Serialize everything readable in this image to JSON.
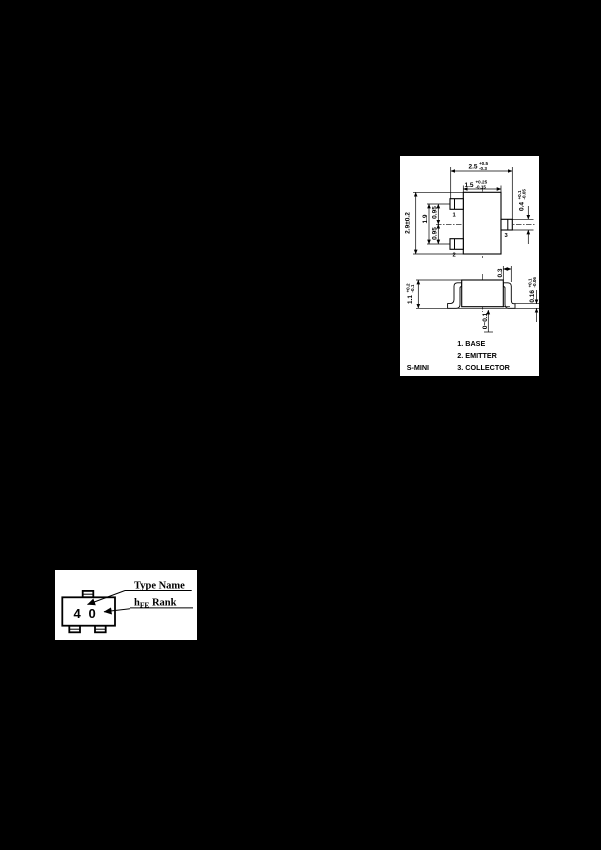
{
  "page": {
    "background_color": "#000000",
    "paper_color": "#ffffff"
  },
  "package_outline": {
    "package_name": "S-MINI",
    "pin_legend": {
      "pin1": "1. BASE",
      "pin2": "2. EMITTER",
      "pin3": "3. COLLECTOR"
    },
    "pin_numbers": {
      "pin1": "1",
      "pin2": "2",
      "pin3": "3"
    },
    "top_view": {
      "overall_width": {
        "value": "2.5",
        "plus": "+0.5",
        "minus": "-0.3"
      },
      "body_width": {
        "value": "1.5",
        "plus": "+0.25",
        "minus": "-0.15"
      },
      "body_height": "2.9±0.2",
      "lead_span": "1.9",
      "lead_pitch_upper": "0.95",
      "lead_pitch_lower": "0.95",
      "collector_lead_width": {
        "value": "0.4",
        "plus": "+0.1",
        "minus": "-0.05"
      }
    },
    "side_view": {
      "body_height": {
        "value": "1.1",
        "plus": "+0.2",
        "minus": "-0.1"
      },
      "lead_length": "0.3",
      "lead_thickness": {
        "value": "0.16",
        "plus": "+0.1",
        "minus": "-0.06"
      },
      "standoff": "0~0.1"
    }
  },
  "marking": {
    "type_name_label": "Type Name",
    "hfe_label_h": "h",
    "hfe_label_sub": "FE",
    "hfe_label_rank": "Rank",
    "type_name_mark": "4",
    "hfe_rank_mark": "0"
  }
}
